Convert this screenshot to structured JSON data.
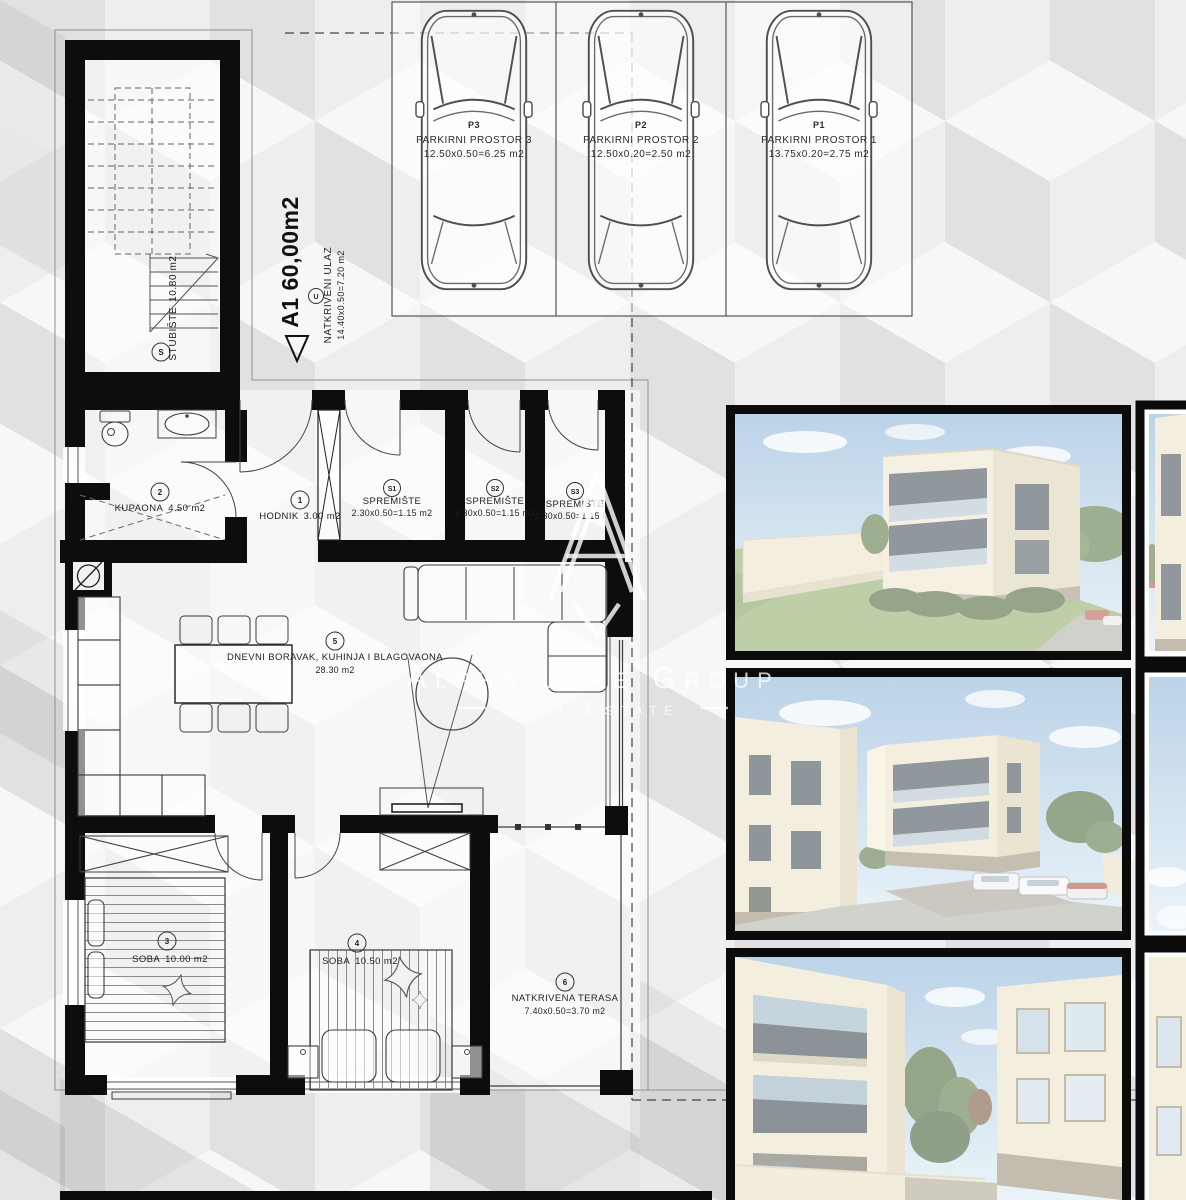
{
  "watermark": {
    "brand": "Alpha Luxe Group",
    "tagline": "Real Estate"
  },
  "unit": {
    "code": "A1",
    "area": "60,00m2",
    "label": "A1 60,00m2"
  },
  "entrance": {
    "tag": "U",
    "name": "NATKRIVENI ULAZ",
    "dims": "14.40x0.50=7.20 m2"
  },
  "rooms": [
    {
      "tag": "S",
      "name": "STUBIŠTE",
      "area": "10.80 m2"
    },
    {
      "tag": "2",
      "name": "KUPAONA",
      "area": "4.50 m2"
    },
    {
      "tag": "1",
      "name": "HODNIK",
      "area": "3.00 m2"
    },
    {
      "tag": "S1",
      "name": "SPREMIŠTE",
      "area": "2.30x0.50=1.15 m2"
    },
    {
      "tag": "S2",
      "name": "SPREMIŠTE",
      "area": "2.30x0.50=1.15 m2"
    },
    {
      "tag": "S3",
      "name": "SPREMIŠTE",
      "area": "2.30x0.50=1.15 m2"
    },
    {
      "tag": "5",
      "name": "DNEVNI BORAVAK, KUHINJA I BLAGOVAONA",
      "area": "28.30 m2"
    },
    {
      "tag": "3",
      "name": "SOBA",
      "area": "10.00 m2"
    },
    {
      "tag": "4",
      "name": "SOBA",
      "area": "10.50 m2"
    },
    {
      "tag": "6",
      "name": "NATKRIVENA TERASA",
      "area": "7.40x0.50=3.70 m2"
    }
  ],
  "parking": [
    {
      "tag": "P3",
      "name": "PARKIRNI PROSTOR 3",
      "dims": "12.50x0.50=6.25 m2"
    },
    {
      "tag": "P2",
      "name": "PARKIRNI PROSTOR 2",
      "dims": "12.50x0.20=2.50 m2"
    },
    {
      "tag": "P1",
      "name": "PARKIRNI PROSTOR 1",
      "dims": "13.75x0.20=2.75 m2"
    }
  ],
  "colors": {
    "wall": "#0d0d0d",
    "plan_line": "#3c3c3c",
    "text": "#1f1f1f",
    "bg_top_face": "#f7f7f7",
    "bg_left_face": "#e1e1e1",
    "bg_right_face": "#eeeeee",
    "watermark": "rgba(255,255,255,0.82)",
    "render_sky": "#8fb6d9",
    "render_building": "#ece3c8",
    "render_window": "#46525c",
    "render_grass": "#93ad6b",
    "render_frame": "#0b0b0b",
    "render_overlay": "rgba(255,255,255,0.40)"
  }
}
